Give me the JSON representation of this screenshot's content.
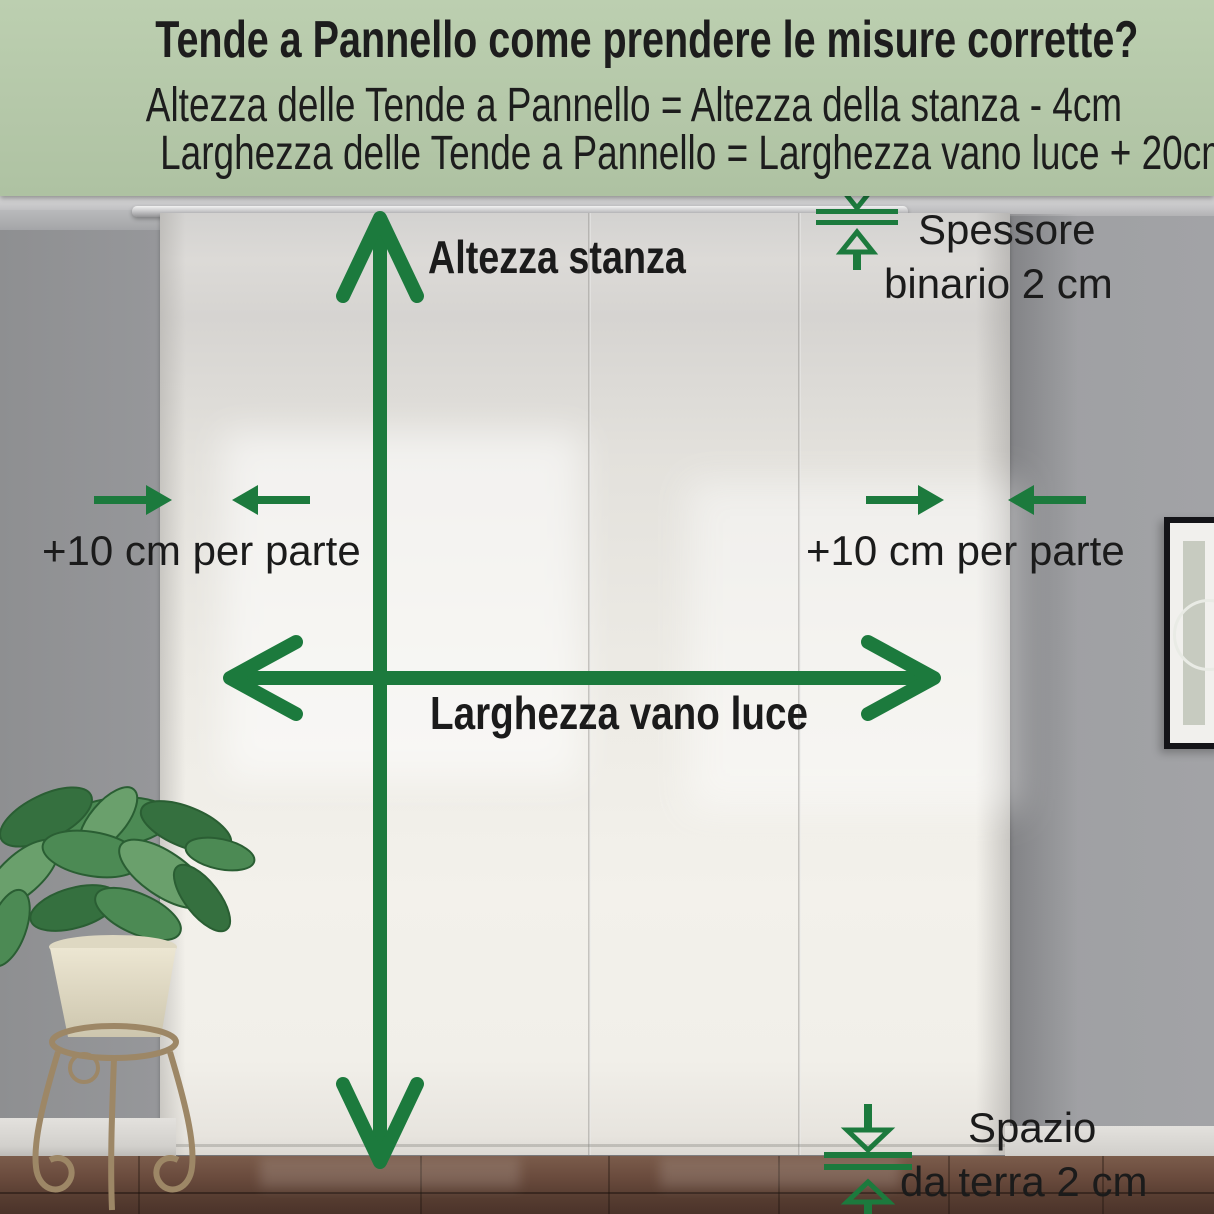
{
  "header": {
    "title": "Tende a Pannello come prendere le misure corrette?",
    "formula_height": "Altezza delle Tende a Pannello = Altezza della stanza - 4cm",
    "formula_width": "Larghezza delle Tende a Pannello = Larghezza vano luce + 20cm"
  },
  "labels": {
    "room_height": "Altezza stanza",
    "opening_width": "Larghezza vano luce",
    "left_margin": "+10 cm per parte",
    "right_margin": "+10 cm per parte",
    "track_thickness_line1": "Spessore",
    "track_thickness_line2": "binario 2 cm",
    "floor_gap_line1": "Spazio",
    "floor_gap_line2": "da terra 2 cm"
  },
  "colors": {
    "annotation_green": "#1c7a3d",
    "header_background": "#b4c7a8",
    "text_black": "#1b1b1b"
  },
  "icons": {
    "vertical_measure": "double-headed-vertical-arrow",
    "horizontal_measure": "double-headed-horizontal-arrow",
    "side_margin_arrows": "converging-horizontal-arrows",
    "track_thickness": "gap-between-two-lines-indicator",
    "floor_gap": "gap-between-two-lines-indicator",
    "plant": "potted-plant-on-stand",
    "picture": "framed-wall-art"
  }
}
